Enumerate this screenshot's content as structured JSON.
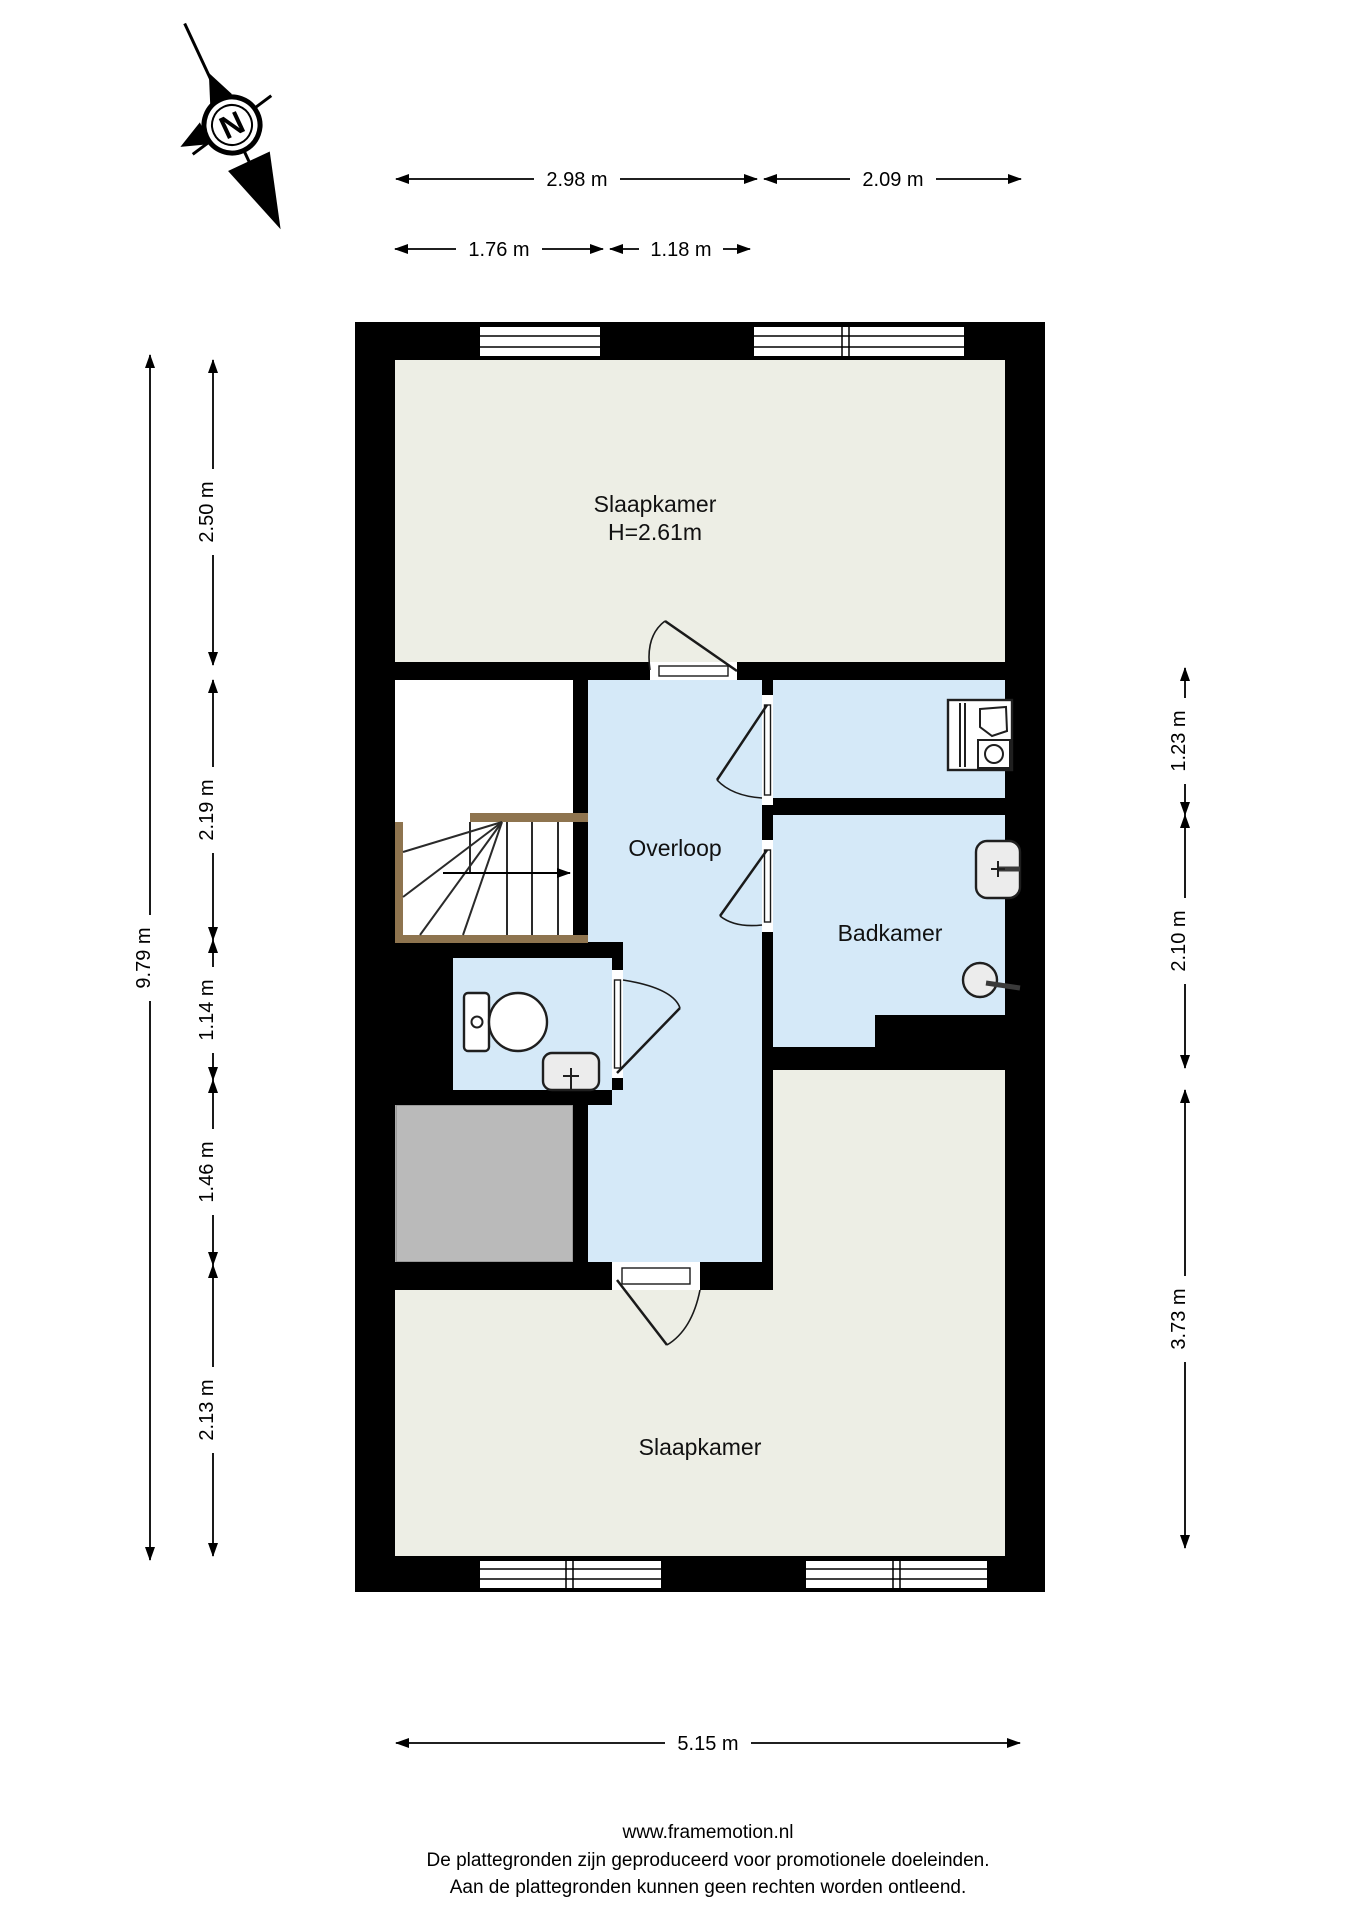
{
  "compass": {
    "north_letter": "N"
  },
  "rooms": {
    "bedroom_top": {
      "label": "Slaapkamer",
      "height_note": "H=2.61m"
    },
    "landing": {
      "label": "Overloop"
    },
    "bathroom": {
      "label": "Badkamer"
    },
    "bedroom_bottom": {
      "label": "Slaapkamer"
    }
  },
  "dimensions": {
    "top_row_1": [
      {
        "label": "2.98 m"
      },
      {
        "label": "2.09 m"
      }
    ],
    "top_row_2": [
      {
        "label": "1.76 m"
      },
      {
        "label": "1.18 m"
      }
    ],
    "left_total": {
      "label": "9.79 m"
    },
    "left_segments": [
      {
        "label": "2.50 m"
      },
      {
        "label": "2.19 m"
      },
      {
        "label": "1.14 m"
      },
      {
        "label": "1.46 m"
      },
      {
        "label": "2.13 m"
      }
    ],
    "right_segments": [
      {
        "label": "1.23 m"
      },
      {
        "label": "2.10 m"
      },
      {
        "label": "3.73 m"
      }
    ],
    "bottom_total": {
      "label": "5.15 m"
    }
  },
  "footer": {
    "website": "www.framemotion.nl",
    "line1": "De plattegronden zijn geproduceerd voor promotionele doeleinden.",
    "line2": "Aan de plattegronden kunnen geen rechten worden ontleend."
  },
  "icons": {
    "compass": "compass-rose-icon",
    "washing_machine": "washing-machine-icon",
    "bathroom_sink": "washbasin-icon",
    "shower": "shower-head-icon",
    "toilet": "toilet-icon",
    "hand_basin": "hand-basin-icon",
    "stairs": "staircase-icon",
    "stair_arrow": "stair-direction-arrow-icon"
  },
  "colors": {
    "background": "#ffffff",
    "wall": "#000000",
    "room_floor": "#edeee5",
    "wet_floor": "#d5e9f8",
    "closet_floor": "#ffffff",
    "storage_floor": "#bababa",
    "stair_wood": "#8e744f"
  }
}
